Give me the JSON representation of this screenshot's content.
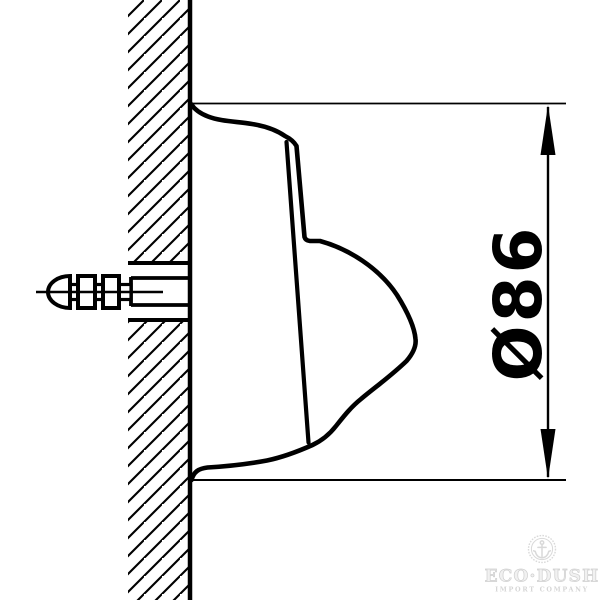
{
  "drawing": {
    "type": "technical-installation-side-view",
    "dimension": {
      "label": "Ø86",
      "orientation": "rotated-90-ccw"
    }
  },
  "logo": {
    "brand": "ECO·DUSH",
    "tagline": "IMPORT COMPANY",
    "icon": "anchor-icon"
  },
  "colors": {
    "line": "#000000",
    "background": "#ffffff",
    "logo_gray": "#d9d9d9",
    "logo_gray_light": "#ededed"
  }
}
